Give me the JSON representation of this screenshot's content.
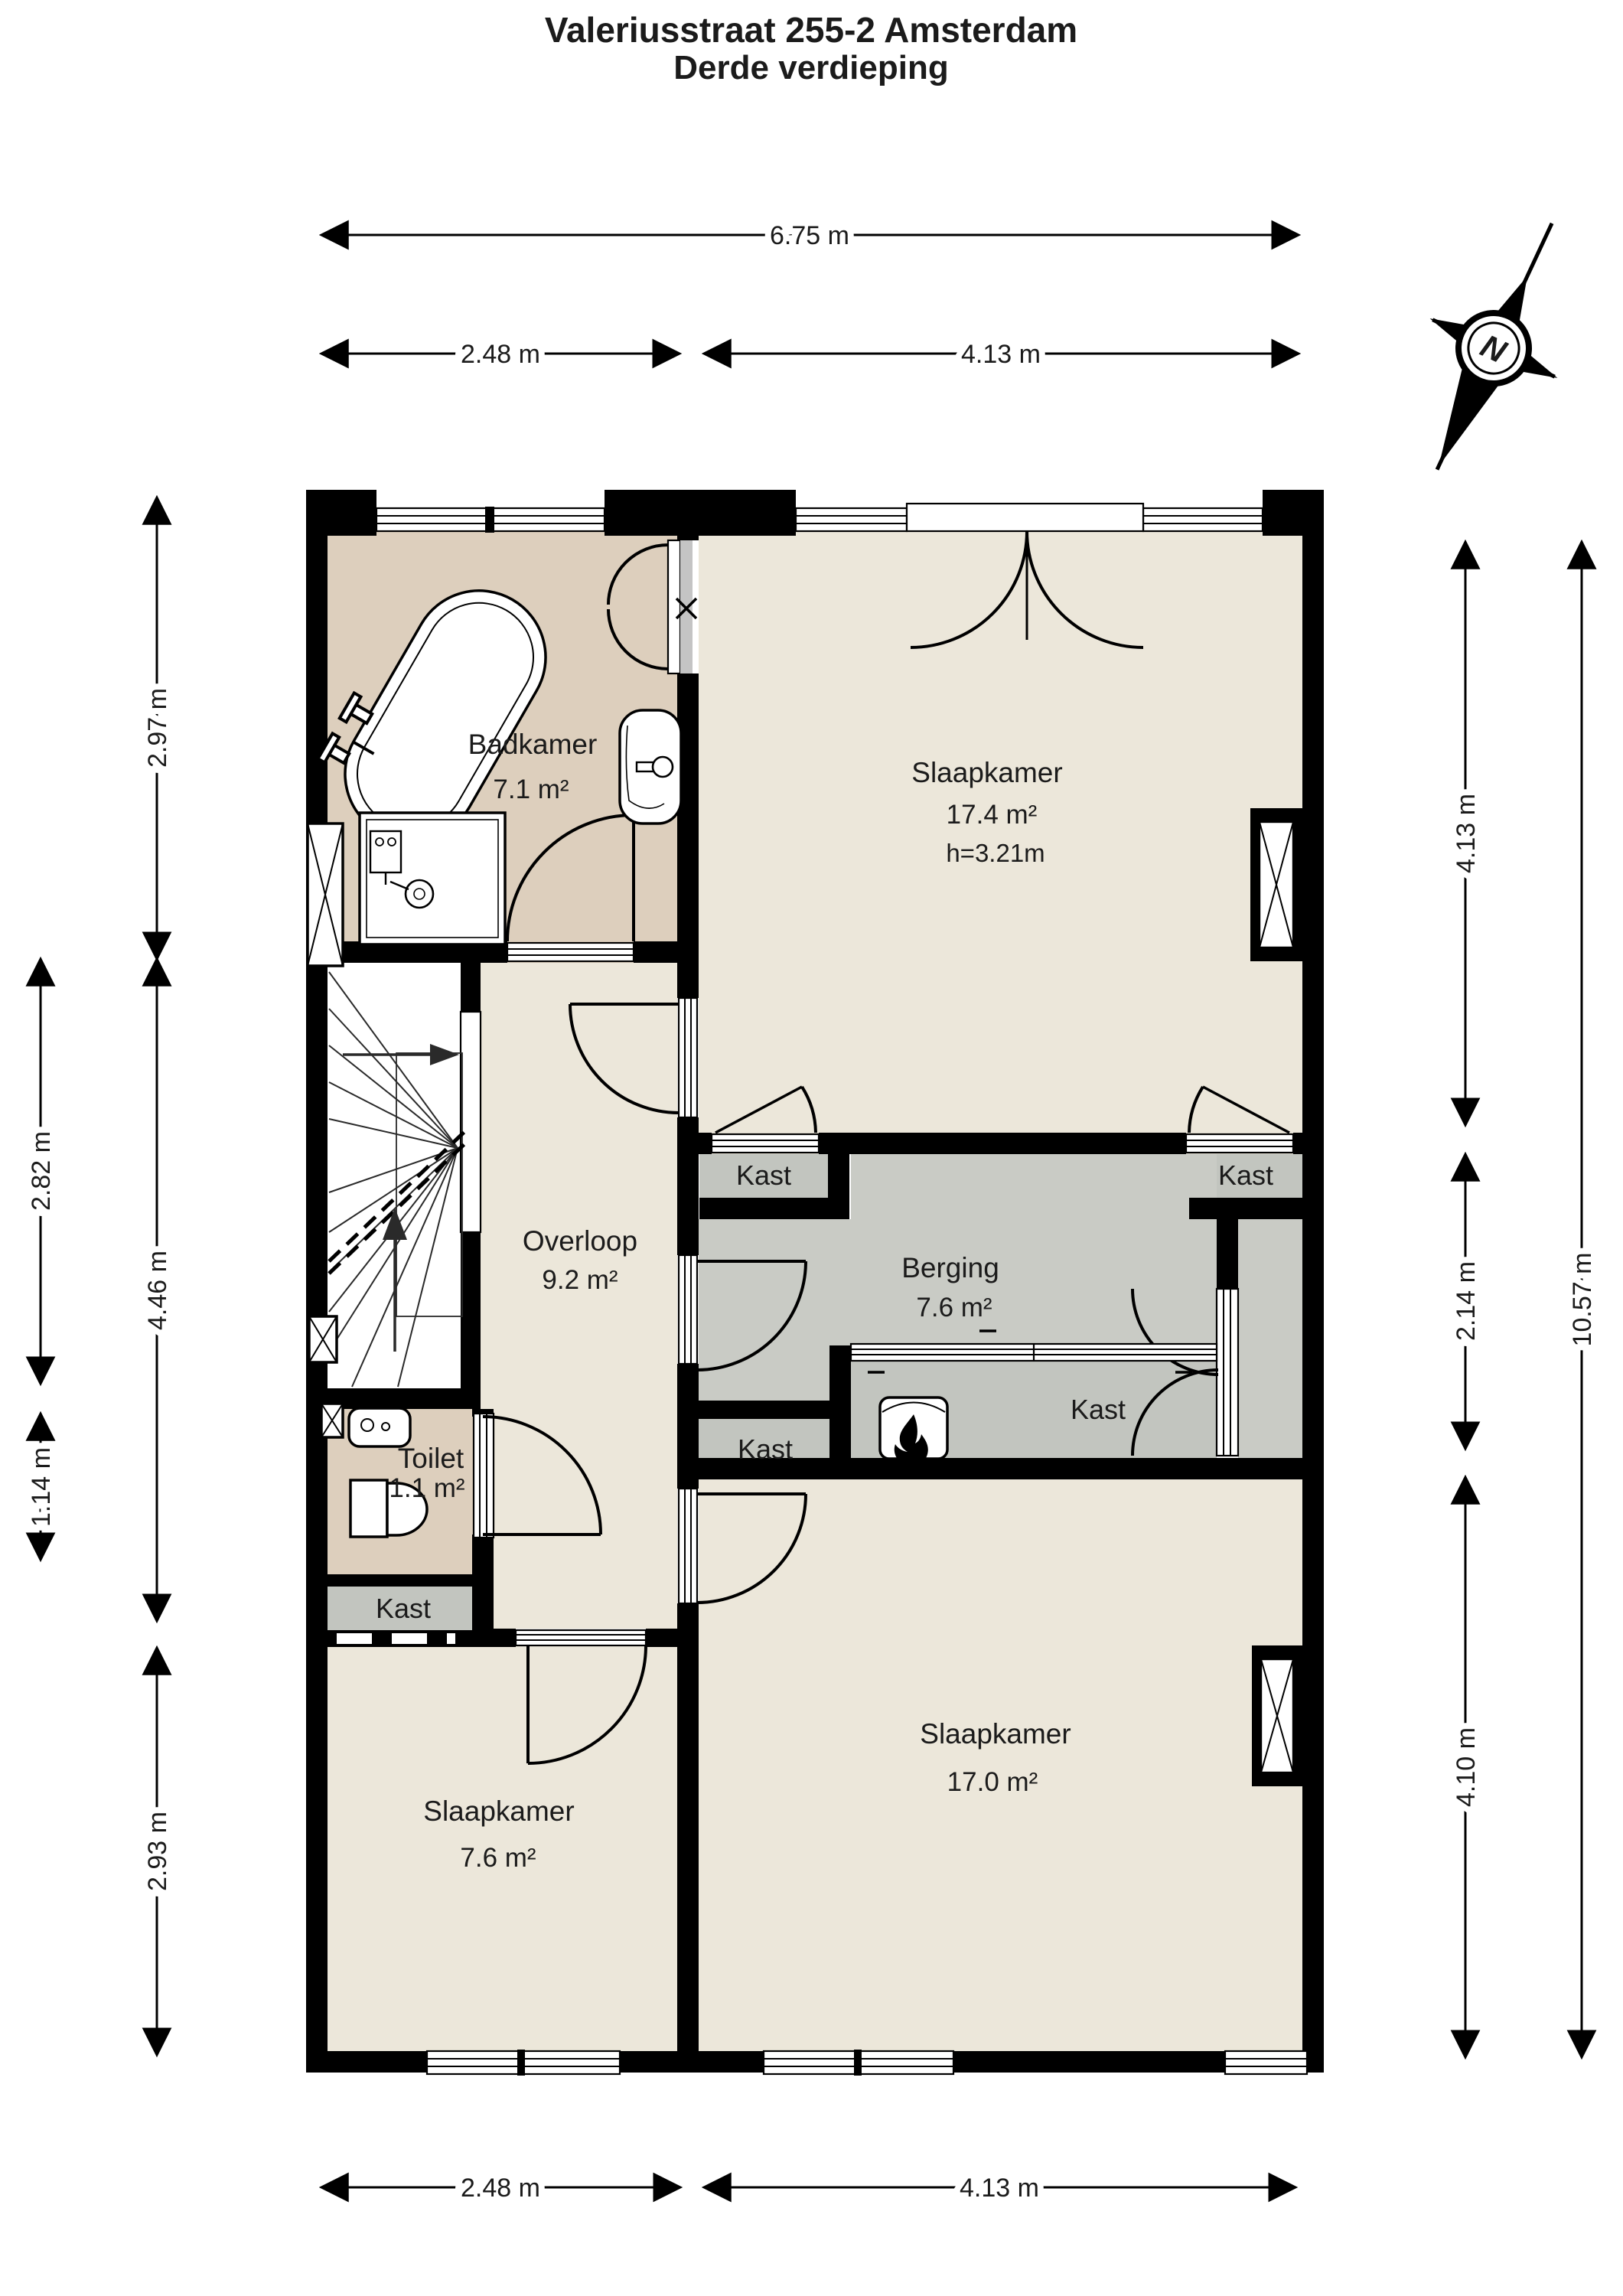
{
  "title": {
    "line1": "Valeriusstraat 255-2 Amsterdam",
    "line2": "Derde verdieping"
  },
  "compass": {
    "label": "N"
  },
  "rooms": {
    "badkamer": {
      "name": "Badkamer",
      "area": "7.1 m²"
    },
    "slaapkamer_boven": {
      "name": "Slaapkamer",
      "area": "17.4 m²",
      "ceiling": "h=3.21m"
    },
    "overloop": {
      "name": "Overloop",
      "area": "9.2 m²"
    },
    "berging": {
      "name": "Berging",
      "area": "7.6 m²"
    },
    "toilet": {
      "name": "Toilet",
      "area": "1.1 m²"
    },
    "slaapkamer_linksonder": {
      "name": "Slaapkamer",
      "area": "7.6 m²"
    },
    "slaapkamer_rechtsonder": {
      "name": "Slaapkamer",
      "area": "17.0 m²"
    }
  },
  "closets": {
    "kast_overloop": "Kast",
    "kast_rechts": "Kast",
    "kast_berging": "Kast",
    "kast_west": "Kast",
    "kast_toilet": "Kast"
  },
  "dimensions": {
    "top_total": "6.75 m",
    "top_left": "2.48 m",
    "top_right": "4.13 m",
    "bottom_left": "2.48 m",
    "bottom_right": "4.13 m",
    "left_outer_top": "2.82 m",
    "left_outer_bottom": "1.14 m",
    "left_inner_top": "2.97 m",
    "left_inner_mid": "4.46 m",
    "left_inner_bottom": "2.93 m",
    "right_inner_top": "4.13 m",
    "right_inner_mid": "2.14 m",
    "right_inner_bottom": "4.10 m",
    "right_outer": "10.57 m"
  },
  "colors": {
    "wall": "#000000",
    "floor": "#ECE7DA",
    "wet_room": "#DDCFBD",
    "storage": "#C9CBC5",
    "closet": "#C2C5BF",
    "paper": "#FFFFFF"
  }
}
